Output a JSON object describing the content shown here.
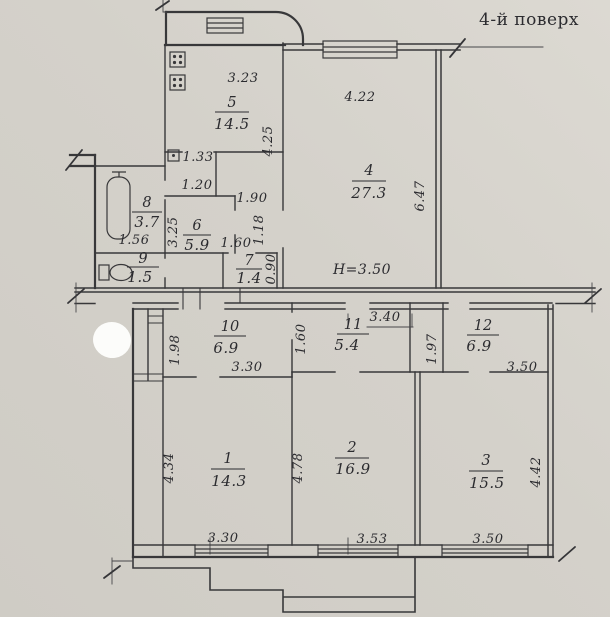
{
  "title": "4-й поверх",
  "ceiling_height": "H=3.50",
  "rooms": {
    "r1": {
      "num": "1",
      "area": "14.3"
    },
    "r2": {
      "num": "2",
      "area": "16.9"
    },
    "r3": {
      "num": "3",
      "area": "15.5"
    },
    "r4": {
      "num": "4",
      "area": "27.3"
    },
    "r5": {
      "num": "5",
      "area": "14.5"
    },
    "r6": {
      "num": "6",
      "area": "5.9"
    },
    "r7": {
      "num": "7",
      "area": "1.4"
    },
    "r8": {
      "num": "8",
      "area": "3.7"
    },
    "r9": {
      "num": "9",
      "area": "1.5"
    },
    "r10": {
      "num": "10",
      "area": "6.9"
    },
    "r11": {
      "num": "11",
      "area": "5.4"
    },
    "r12": {
      "num": "12",
      "area": "6.9"
    }
  },
  "dims": {
    "d323": "3.23",
    "d425": "4.25",
    "d422": "4.22",
    "d647": "6.47",
    "d133": "1.33",
    "d120": "1.20",
    "d190": "1.90",
    "d325": "3.25",
    "d118": "1.18",
    "d156": "1.56",
    "d160a": "1.60",
    "d090": "0.90",
    "d340": "3.40",
    "d198": "1.98",
    "d160b": "1.60",
    "d197": "1.97",
    "d330a": "3.30",
    "d350a": "3.50",
    "d434": "4.34",
    "d478": "4.78",
    "d442": "4.42",
    "d330b": "3.30",
    "d353": "3.53",
    "d350b": "3.50"
  },
  "colors": {
    "paper": "#d4d1ca",
    "paper_light": "#dcd9d2",
    "ink": "#38383a",
    "text": "#2b2b2f",
    "whiteout": "#fcfcfa"
  }
}
